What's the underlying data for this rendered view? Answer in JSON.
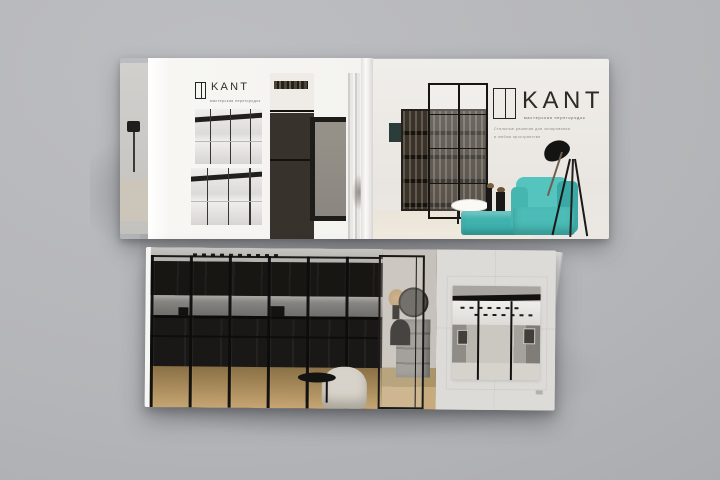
{
  "brand": {
    "name": "KANT",
    "subtitle": "мастерская перегородок",
    "tagline_line1": "Стильные решения для зонирования",
    "tagline_line2": "в любом пространстве"
  },
  "colors": {
    "backdrop_gray": "#b4b5b8",
    "page_white": "#f6f5f2",
    "cover_background": "#edebe6",
    "accent_teal": "#4cbcb7",
    "frame_black": "#1b1a17",
    "kitchen_dark": "#1c1b19",
    "wood_floor": "#bb9a68"
  },
  "objects": {
    "top_spread": {
      "left_page": [
        "kant-logo",
        "wardrobe-partition-photo-top",
        "wardrobe-partition-photo-bottom",
        "shelf-and-fluted-glass-photo"
      ],
      "cover_page": [
        "kant-logo",
        "bookshelf-behind-glass-partition",
        "black-floor-lamp",
        "teal-armchair",
        "teal-ottoman",
        "round-side-table",
        "plant-pedestals"
      ]
    },
    "bottom_catalog": [
      "kitchen-behind-glass-partition-photo",
      "hallway-dresser-and-mirror",
      "sliding-glass-door",
      "white-armchair",
      "black-side-table",
      "inset-room-photo",
      "fanned-page-edges"
    ]
  }
}
